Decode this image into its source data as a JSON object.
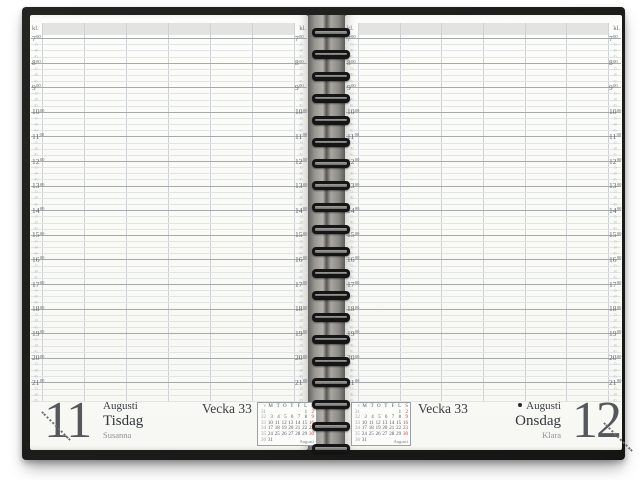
{
  "planner": {
    "time_header": "kl.",
    "hours": [
      "7",
      "8",
      "9",
      "10",
      "11",
      "12",
      "13",
      "14",
      "15",
      "16",
      "17",
      "18",
      "19",
      "20",
      "21"
    ],
    "hour_superscript": "00",
    "quarter_labels": [
      "15",
      "30",
      "45"
    ],
    "left_page": {
      "day_number": "11",
      "month": "Augusti",
      "weekday": "Tisdag",
      "name_day": "Susanna",
      "week_label": "Vecka 33"
    },
    "right_page": {
      "day_number": "12",
      "month": "Augusti",
      "weekday": "Onsdag",
      "name_day": "Klara",
      "week_label": "Vecka 33",
      "moon_symbol": "new-moon-dot"
    },
    "mini_calendar": {
      "month_label": "Augusti",
      "header": [
        "v",
        "M",
        "T",
        "O",
        "T",
        "F",
        "L",
        "S"
      ],
      "weeks": [
        [
          "31",
          "",
          "",
          "",
          "",
          "",
          "1",
          "2"
        ],
        [
          "32",
          "3",
          "4",
          "5",
          "6",
          "7",
          "8",
          "9"
        ],
        [
          "33",
          "10",
          "11",
          "12",
          "13",
          "14",
          "15",
          "16"
        ],
        [
          "34",
          "17",
          "18",
          "19",
          "20",
          "21",
          "22",
          "23"
        ],
        [
          "35",
          "24",
          "25",
          "26",
          "27",
          "28",
          "29",
          "30"
        ],
        [
          "36",
          "31",
          "",
          "",
          "",
          "",
          "",
          ""
        ]
      ]
    },
    "colors": {
      "cover": "#1a1a19",
      "page": "#fbfbf9",
      "header_band": "#e3e3e1",
      "hour_line": "#a6aaad",
      "quarter_line": "#e1e3e4",
      "column_line": "#cfd2d4",
      "text_dark": "#3c4043",
      "text_gray": "#8f9396",
      "sunday_red": "#a9453f"
    }
  }
}
